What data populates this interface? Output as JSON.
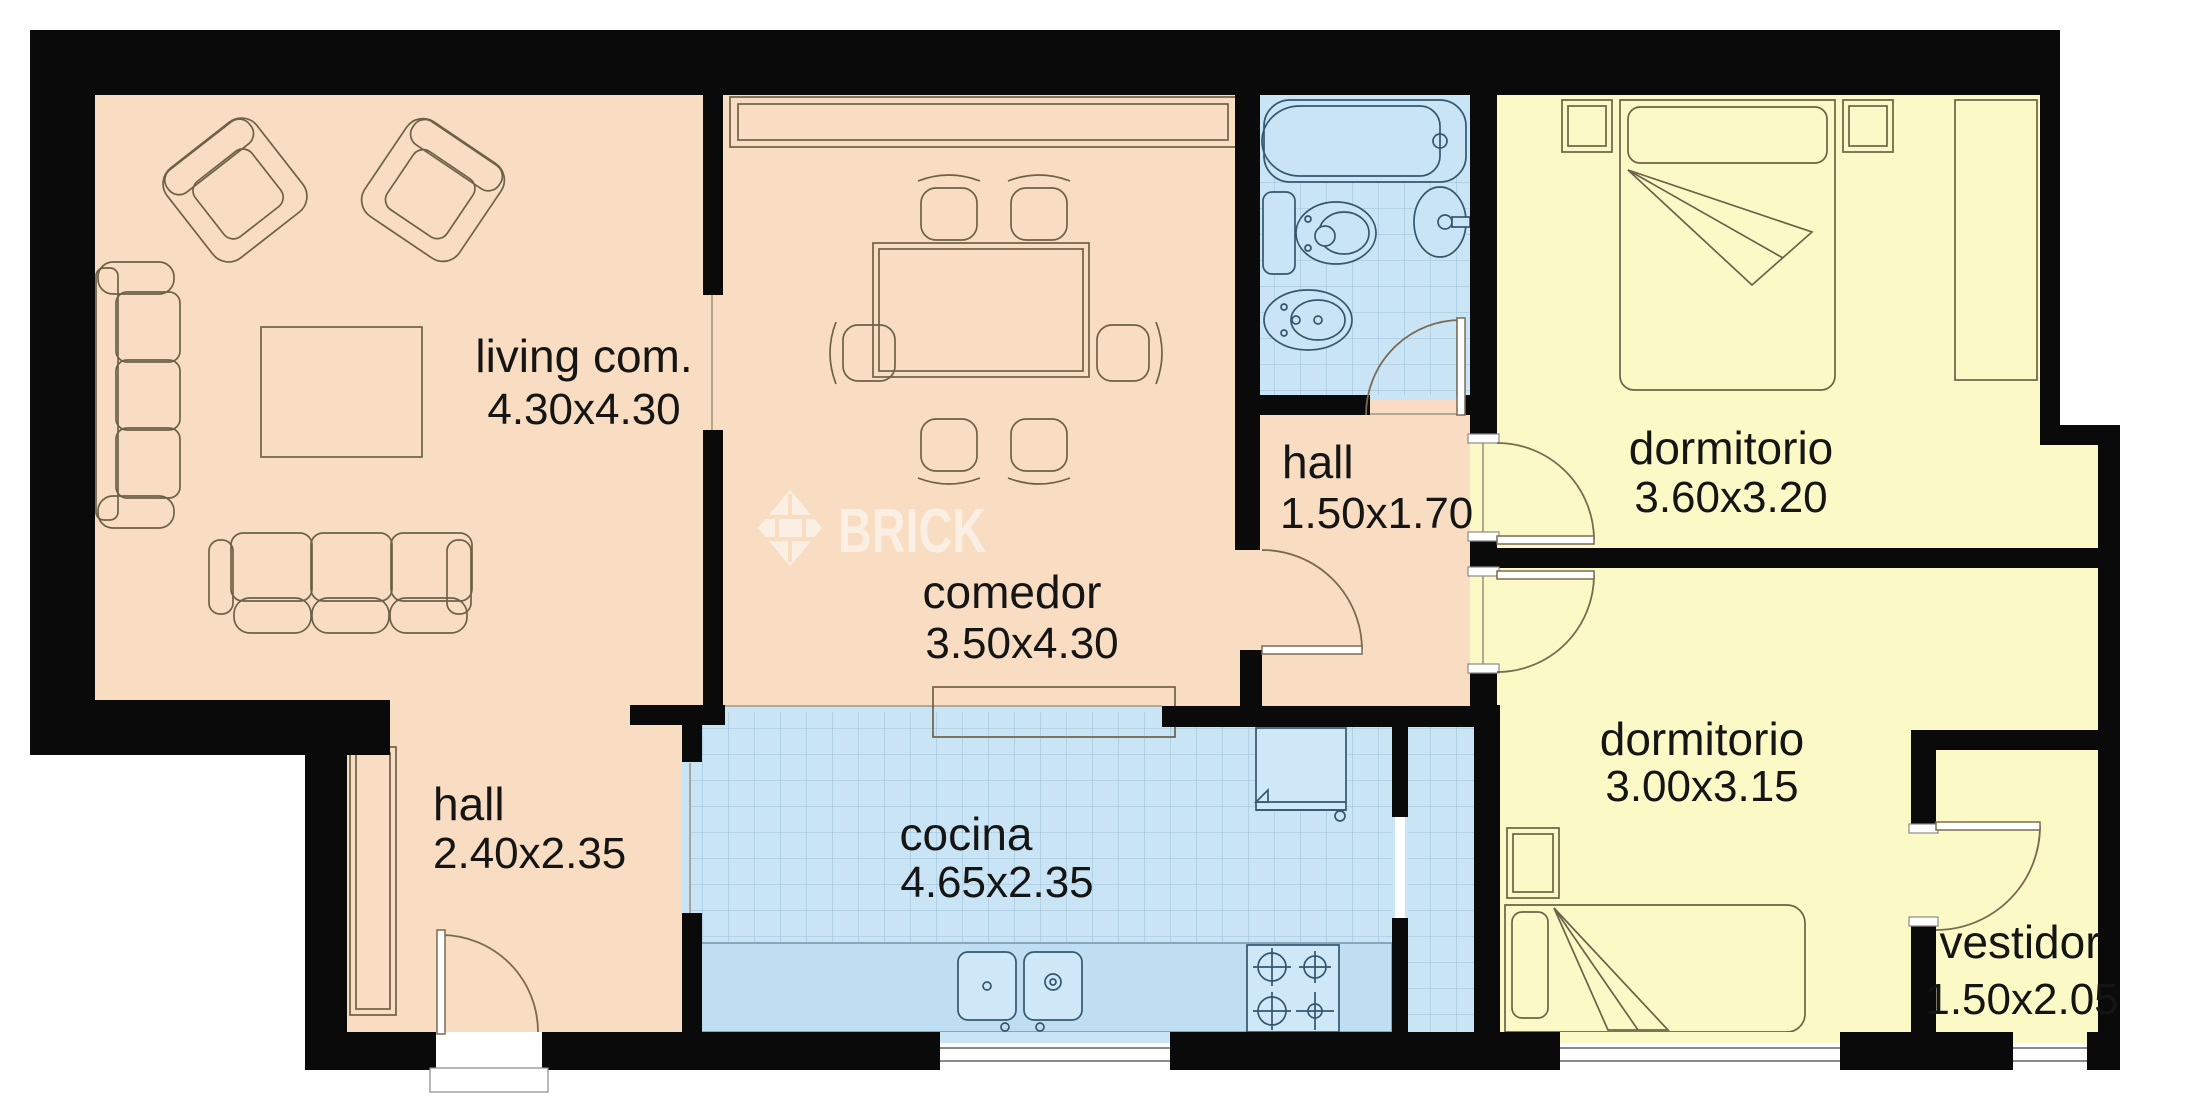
{
  "watermark": {
    "brand": "BRICK"
  },
  "rooms": [
    {
      "id": "living",
      "label": "living com.",
      "dims": "4.30x4.30"
    },
    {
      "id": "comedor",
      "label": "comedor",
      "dims": "3.50x4.30"
    },
    {
      "id": "hall-small",
      "label": "hall",
      "dims": "1.50x1.70"
    },
    {
      "id": "dormitorio-top",
      "label": "dormitorio",
      "dims": "3.60x3.20"
    },
    {
      "id": "dormitorio-low",
      "label": "dormitorio",
      "dims": "3.00x3.15"
    },
    {
      "id": "vestidor",
      "label": "vestidor",
      "dims": "1.50x2.05"
    },
    {
      "id": "hall-entry",
      "label": "hall",
      "dims": "2.40x2.35"
    },
    {
      "id": "cocina",
      "label": "cocina",
      "dims": "4.65x2.35"
    }
  ],
  "colors": {
    "floor_social": "#f8ddc2",
    "floor_bedroom": "#fbfac7",
    "floor_wet": "#c9e4f5",
    "wall": "#0a0a0a",
    "watermark": "#ffffff"
  }
}
